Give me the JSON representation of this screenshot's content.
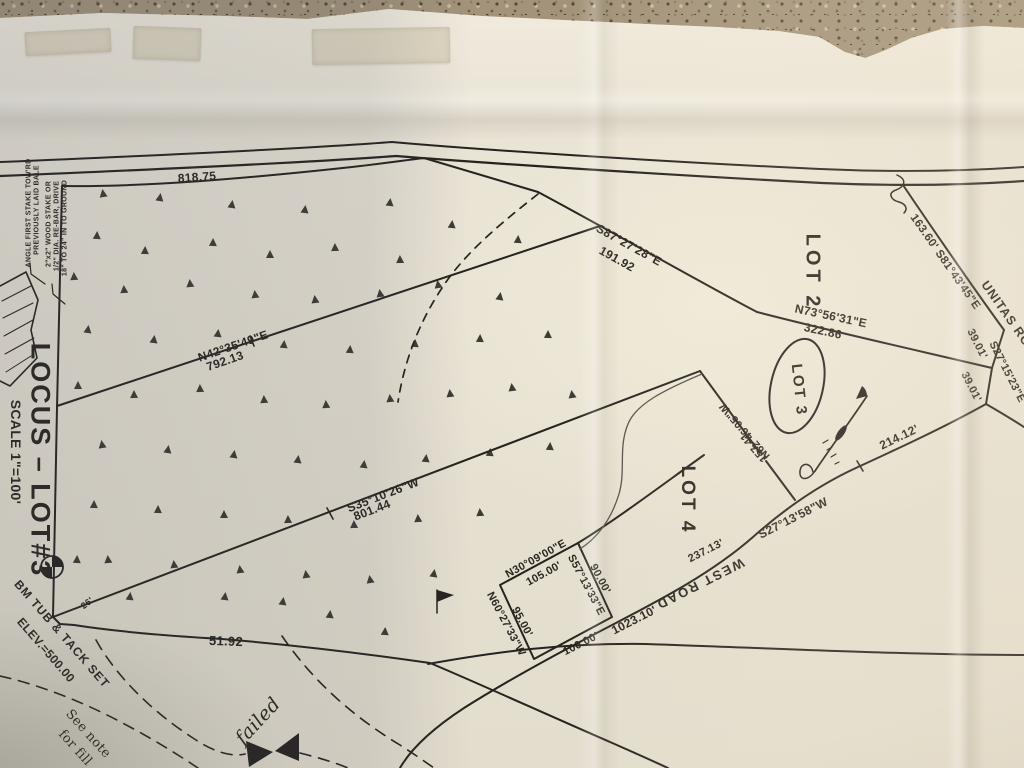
{
  "photo": {
    "ink_color": "#26231f",
    "paper_color": "#e7e1d3",
    "countertop_color": "#a2937a"
  },
  "title_block": {
    "locus": "LOCUS – LOT#3",
    "scale": "SCALE 1\"=100'"
  },
  "lots": [
    "LOT 2",
    "LOT 3",
    "LOT 4"
  ],
  "roads": [
    "UNITAS ROAD",
    "WEST ROAD"
  ],
  "benchmark": [
    "BM TUB & TACK SET",
    "ELEV.=500.00"
  ],
  "annotations": [
    {
      "name": "stake-note-line",
      "text": "ANGLE FIRST STAKE TOW'RD",
      "x": 29,
      "y": 213,
      "rot": -90,
      "size": 7
    },
    {
      "name": "stake-note-line",
      "text": "PREVIOUSLY LAID BALE",
      "x": 37,
      "y": 210,
      "rot": -90,
      "size": 7
    },
    {
      "name": "stake-note-line",
      "text": "2\"x2\" WOOD STAKE OR",
      "x": 49,
      "y": 224,
      "rot": -90,
      "size": 7
    },
    {
      "name": "stake-note-line",
      "text": "1/2\" DIA. RE-BAR, DRIVE",
      "x": 57,
      "y": 226,
      "rot": -90,
      "size": 7
    },
    {
      "name": "stake-note-line",
      "text": "18\" TO 24\" IN TO GROUND",
      "x": 65,
      "y": 228,
      "rot": -90,
      "size": 7
    },
    {
      "name": "distance-label",
      "text": "818.75",
      "x": 197,
      "y": 177,
      "rot": -4,
      "size": 12
    },
    {
      "name": "bearing-label",
      "text": "S87°27'28\"E",
      "x": 629,
      "y": 245,
      "rot": 29,
      "size": 12
    },
    {
      "name": "distance-label",
      "text": "191.92",
      "x": 617,
      "y": 259,
      "rot": 29,
      "size": 12
    },
    {
      "name": "lot2-label",
      "text": "LOT 2",
      "x": 812,
      "y": 272,
      "rot": 90,
      "size": 20,
      "sp": 4
    },
    {
      "name": "bearing-label",
      "text": "163.60' S81°43'45\"E",
      "x": 945,
      "y": 262,
      "rot": 55,
      "size": 11.5
    },
    {
      "name": "unitas-road-label",
      "text": "UNITAS ROAD",
      "x": 1012,
      "y": 322,
      "rot": 55,
      "size": 12.5,
      "sp": 1
    },
    {
      "name": "bearing-label",
      "text": "N73°56'31\"E",
      "x": 831,
      "y": 316,
      "rot": 12,
      "size": 12
    },
    {
      "name": "distance-label",
      "text": "322.86",
      "x": 823,
      "y": 331,
      "rot": 12,
      "size": 12
    },
    {
      "name": "distance-label",
      "text": "39.01'",
      "x": 977,
      "y": 344,
      "rot": 63,
      "size": 11
    },
    {
      "name": "bearing-label",
      "text": "S27°15'23\"E",
      "x": 1007,
      "y": 372,
      "rot": 63,
      "size": 11
    },
    {
      "name": "distance-label",
      "text": "39.01'",
      "x": 971,
      "y": 387,
      "rot": 63,
      "size": 11
    },
    {
      "name": "lot3-label",
      "text": "LOT 3",
      "x": 799,
      "y": 390,
      "rot": 84,
      "size": 15,
      "sp": 2
    },
    {
      "name": "distance-label",
      "text": "214.12'",
      "x": 899,
      "y": 437,
      "rot": -26,
      "size": 12
    },
    {
      "name": "bearing-label",
      "text": "N42°35'49\"E",
      "x": 233,
      "y": 346,
      "rot": -19,
      "size": 12
    },
    {
      "name": "distance-label",
      "text": "792.13",
      "x": 225,
      "y": 361,
      "rot": -19,
      "size": 12
    },
    {
      "name": "bearing-label",
      "text": "S35°10'26\"W",
      "x": 383,
      "y": 495,
      "rot": -21,
      "size": 12
    },
    {
      "name": "distance-label",
      "text": "801.44",
      "x": 372,
      "y": 510,
      "rot": -21,
      "size": 12
    },
    {
      "name": "bearing-label",
      "text": "N62°46'05\"W",
      "x": 745,
      "y": 431,
      "rot": -131,
      "size": 11
    },
    {
      "name": "distance-label",
      "text": "157.41",
      "x": 754,
      "y": 447,
      "rot": -131,
      "size": 11
    },
    {
      "name": "lot4-label",
      "text": "LOT 4",
      "x": 687,
      "y": 500,
      "rot": 90,
      "size": 19,
      "sp": 3
    },
    {
      "name": "bearing-label",
      "text": "S27°13'58\"W",
      "x": 793,
      "y": 518,
      "rot": -27,
      "size": 12
    },
    {
      "name": "distance-label",
      "text": "237.13'",
      "x": 706,
      "y": 551,
      "rot": -27,
      "size": 11
    },
    {
      "name": "west-road-label",
      "text": "WEST ROAD",
      "x": 700,
      "y": 584,
      "rot": 153,
      "size": 13,
      "sp": 2
    },
    {
      "name": "distance-label",
      "text": "1023.10'",
      "x": 634,
      "y": 620,
      "rot": -27,
      "size": 12
    },
    {
      "name": "bearing-label",
      "text": "N30°09'00\"E",
      "x": 536,
      "y": 559,
      "rot": -29,
      "size": 11
    },
    {
      "name": "distance-label",
      "text": "105.00'",
      "x": 544,
      "y": 574,
      "rot": -29,
      "size": 11
    },
    {
      "name": "bearing-label",
      "text": "S57°13'33\"E",
      "x": 586,
      "y": 585,
      "rot": 62,
      "size": 11
    },
    {
      "name": "distance-label",
      "text": "90.00'",
      "x": 600,
      "y": 579,
      "rot": 62,
      "size": 11
    },
    {
      "name": "distance-label",
      "text": "100.00'",
      "x": 581,
      "y": 644,
      "rot": -27,
      "size": 11
    },
    {
      "name": "distance-label",
      "text": "95.00'",
      "x": 522,
      "y": 622,
      "rot": 62,
      "size": 11
    },
    {
      "name": "bearing-label",
      "text": "N60°27'33\"W",
      "x": 506,
      "y": 624,
      "rot": 62,
      "size": 11
    },
    {
      "name": "distance-label",
      "text": "51.92",
      "x": 226,
      "y": 641,
      "rot": 2,
      "size": 13
    },
    {
      "name": "distance-label",
      "text": "26'",
      "x": 87,
      "y": 603,
      "rot": -38,
      "size": 9
    },
    {
      "name": "locus-title",
      "text": "LOCUS – LOT#3",
      "x": 40,
      "y": 460,
      "rot": 90,
      "size": 27,
      "sp": 2
    },
    {
      "name": "scale-note",
      "text": "SCALE 1\"=100'",
      "x": 16,
      "y": 452,
      "rot": 90,
      "size": 14
    },
    {
      "name": "benchmark-note",
      "text": "BM TUB & TACK SET",
      "x": 62,
      "y": 634,
      "rot": 49,
      "size": 12,
      "sp": 1
    },
    {
      "name": "benchmark-note",
      "text": "ELEV.=500.00",
      "x": 46,
      "y": 650,
      "rot": 49,
      "size": 12
    },
    {
      "name": "fill-note",
      "text": "See note",
      "x": 88,
      "y": 734,
      "rot": 48,
      "size": 13,
      "cls": "soft"
    },
    {
      "name": "fill-note",
      "text": "for fill",
      "x": 75,
      "y": 748,
      "rot": 48,
      "size": 13,
      "cls": "soft"
    },
    {
      "name": "failed-note",
      "text": "failed",
      "x": 258,
      "y": 721,
      "rot": -47,
      "size": 19,
      "cls": "hand"
    }
  ],
  "trees": [
    [
      103,
      197
    ],
    [
      160,
      201
    ],
    [
      232,
      208
    ],
    [
      305,
      213
    ],
    [
      390,
      206
    ],
    [
      452,
      228
    ],
    [
      518,
      243
    ],
    [
      97,
      239
    ],
    [
      145,
      254
    ],
    [
      213,
      246
    ],
    [
      270,
      258
    ],
    [
      335,
      251
    ],
    [
      400,
      263
    ],
    [
      74,
      280
    ],
    [
      124,
      293
    ],
    [
      190,
      287
    ],
    [
      255,
      298
    ],
    [
      315,
      303
    ],
    [
      380,
      297
    ],
    [
      438,
      288
    ],
    [
      500,
      300
    ],
    [
      88,
      333
    ],
    [
      154,
      343
    ],
    [
      218,
      337
    ],
    [
      284,
      348
    ],
    [
      350,
      353
    ],
    [
      415,
      347
    ],
    [
      480,
      342
    ],
    [
      548,
      338
    ],
    [
      78,
      389
    ],
    [
      134,
      398
    ],
    [
      200,
      392
    ],
    [
      264,
      403
    ],
    [
      326,
      408
    ],
    [
      390,
      402
    ],
    [
      450,
      397
    ],
    [
      512,
      391
    ],
    [
      572,
      398
    ],
    [
      102,
      448
    ],
    [
      168,
      453
    ],
    [
      234,
      458
    ],
    [
      298,
      463
    ],
    [
      364,
      468
    ],
    [
      426,
      462
    ],
    [
      490,
      456
    ],
    [
      550,
      450
    ],
    [
      94,
      508
    ],
    [
      158,
      513
    ],
    [
      224,
      518
    ],
    [
      288,
      523
    ],
    [
      354,
      528
    ],
    [
      418,
      522
    ],
    [
      480,
      516
    ],
    [
      108,
      563
    ],
    [
      174,
      568
    ],
    [
      240,
      573
    ],
    [
      306,
      578
    ],
    [
      370,
      583
    ],
    [
      434,
      577
    ],
    [
      283,
      605
    ],
    [
      225,
      600
    ],
    [
      130,
      600
    ],
    [
      330,
      618
    ],
    [
      385,
      635
    ],
    [
      77,
      563
    ]
  ]
}
